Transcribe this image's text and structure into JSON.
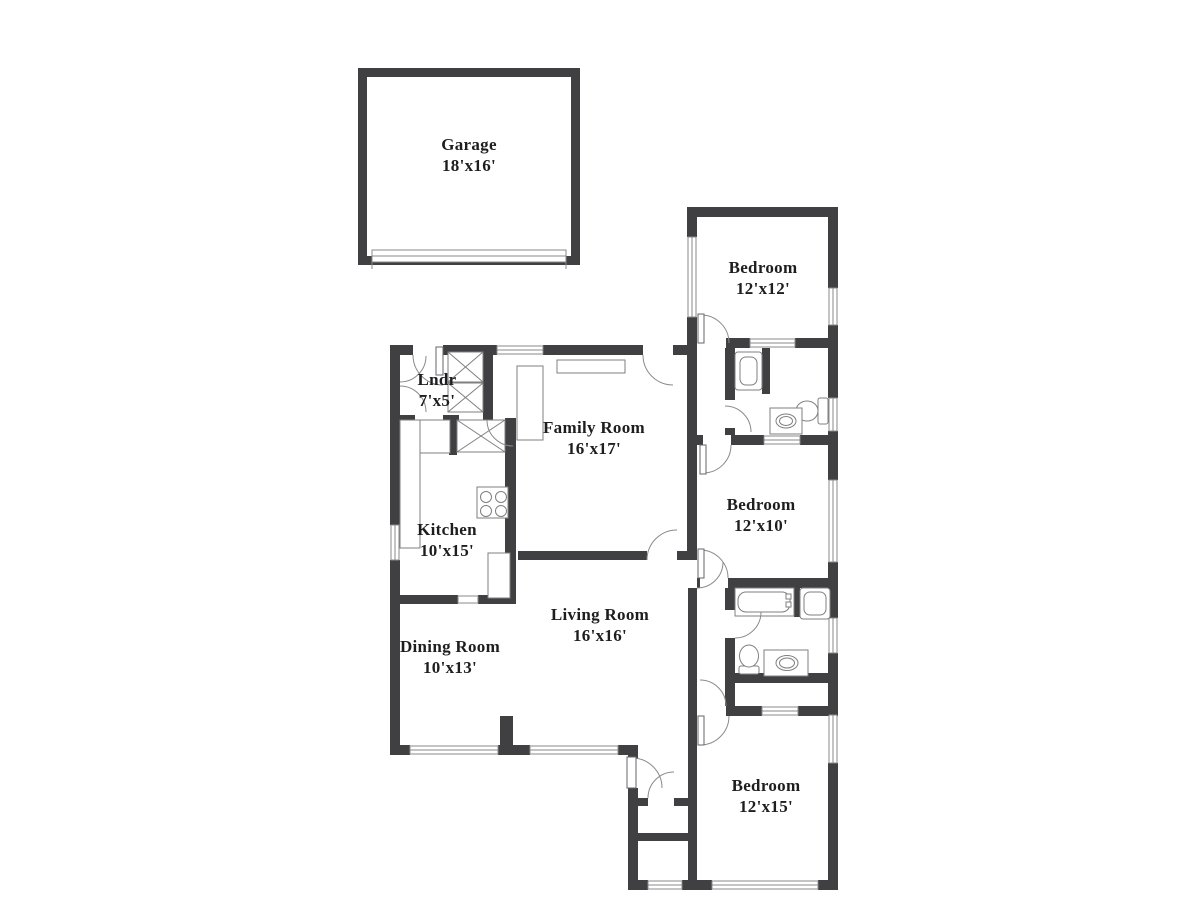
{
  "title": "Single-story house floor plan",
  "palette": {
    "wall": "#404042",
    "thin_line": "#8a8a8a",
    "fixture_line": "#7f7f7f",
    "label_text": "#1e1e20",
    "background": "#ffffff"
  },
  "rooms": [
    {
      "id": "garage",
      "label": "Garage",
      "dims": "18'x16'"
    },
    {
      "id": "laundry",
      "label": "Lndr",
      "dims": "7'x5'"
    },
    {
      "id": "family-room",
      "label": "Family Room",
      "dims": "16'x17'"
    },
    {
      "id": "kitchen",
      "label": "Kitchen",
      "dims": "10'x15'"
    },
    {
      "id": "bedroom-1",
      "label": "Bedroom",
      "dims": "12'x12'"
    },
    {
      "id": "bedroom-2",
      "label": "Bedroom",
      "dims": "12'x10'"
    },
    {
      "id": "living-room",
      "label": "Living Room",
      "dims": "16'x16'"
    },
    {
      "id": "dining-room",
      "label": "Dining Room",
      "dims": "10'x13'"
    },
    {
      "id": "bedroom-3",
      "label": "Bedroom",
      "dims": "12'x15'"
    }
  ],
  "fixtures": [
    "garage-door",
    "washer-dryer",
    "pantry-closet",
    "stove",
    "kitchen-counter",
    "kitchen-island",
    "fireplace",
    "shower",
    "bathtub",
    "toilet",
    "sink-vanity",
    "closet-sliding-doors",
    "windows",
    "door-swings",
    "front-door"
  ]
}
